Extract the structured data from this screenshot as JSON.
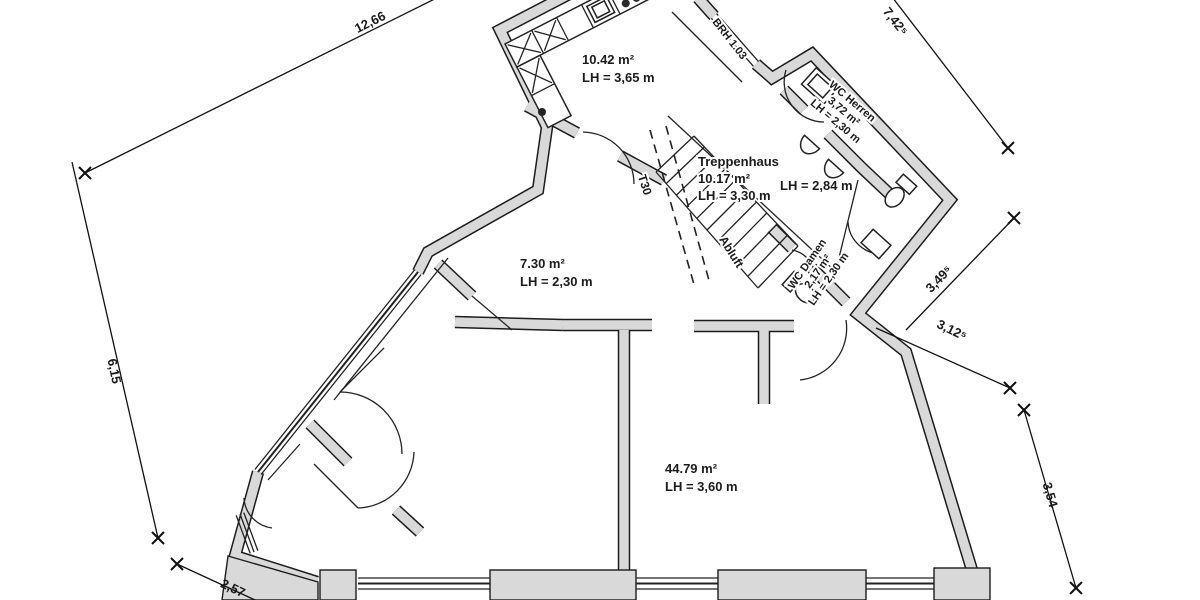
{
  "drawing": {
    "kind": "architectural floor plan (scanned, German annotations)",
    "colors": {
      "paper": "#ffffff",
      "wall_fill": "#d9d9d9",
      "line": "#1c1c1c"
    }
  },
  "rooms": {
    "kitchen": {
      "area": "10.42 m²",
      "height": "LH = 3,65 m"
    },
    "treppenhaus": {
      "name": "Treppenhaus",
      "area": "10.17 m²",
      "height": "LH = 3,30 m"
    },
    "hall": {
      "height": "LH = 2,84 m"
    },
    "wc_herren": {
      "name": "WC Herren",
      "area": "3,72 m²",
      "height": "LH = 2,30 m"
    },
    "wc_damen": {
      "name": "WC Damen",
      "area": "2,17 m²",
      "height": "LH = 2,30 m"
    },
    "room_small": {
      "area": "7.30 m²",
      "height": "LH = 2,30 m"
    },
    "main_room": {
      "area": "44.79 m²",
      "height": "LH = 3,60 m"
    }
  },
  "annotations": {
    "window_sill": "BRH 1.03",
    "fire_door": "T30",
    "exhaust": "Abluft"
  },
  "dimensions": {
    "top_left": "12,66",
    "left": "6,15",
    "bottom_left": "2,57",
    "top_right": "7,42⁵",
    "right_upper": "3,49⁵",
    "right_mid": "3,12⁵",
    "right_lower": "3,54"
  }
}
